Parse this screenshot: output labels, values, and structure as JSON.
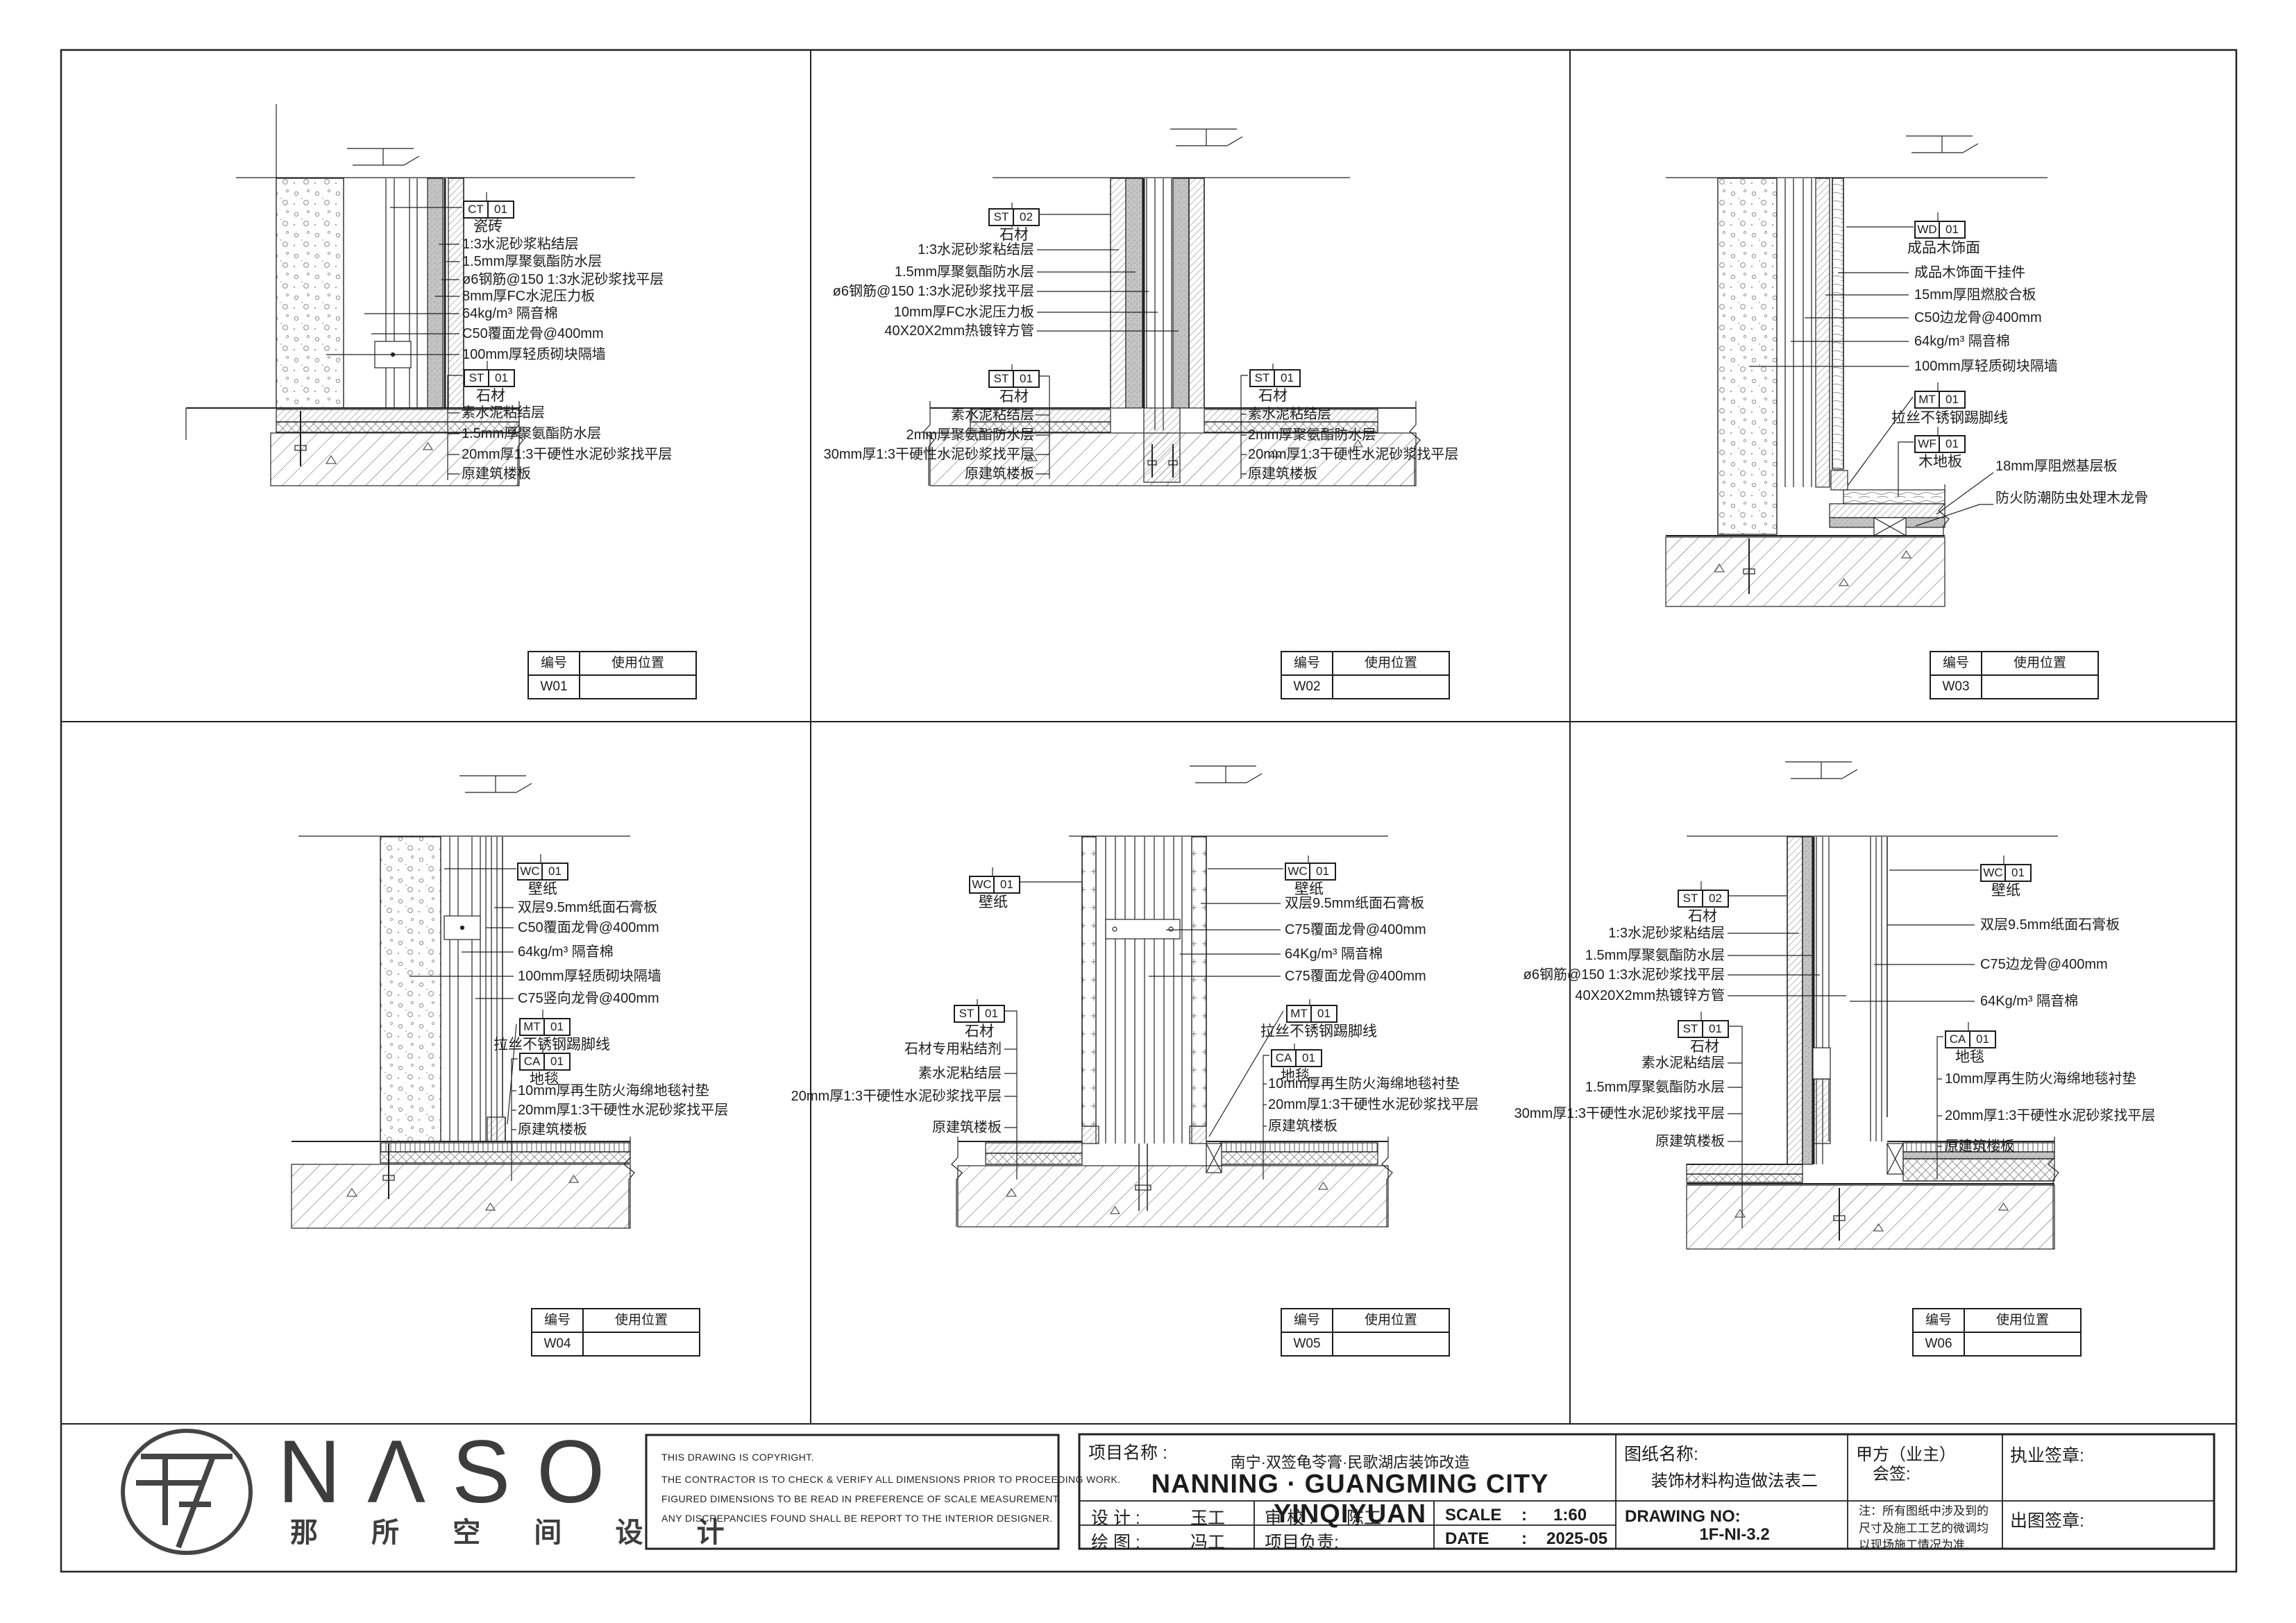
{
  "sheet": {
    "table_headers": {
      "col1": "编号",
      "col2": "使用位置"
    },
    "panels": [
      {
        "id": "W01",
        "tags": [
          {
            "code": "CT",
            "num": "01",
            "name": "瓷砖"
          },
          {
            "code": "ST",
            "num": "01",
            "name": "石材"
          }
        ],
        "g1": [
          "1:3水泥砂浆粘结层",
          "1.5mm厚聚氨酯防水层",
          "ø6钢筋@150 1:3水泥砂浆找平层",
          "8mm厚FC水泥压力板",
          "64kg/m³ 隔音棉",
          "C50覆面龙骨@400mm",
          "100mm厚轻质砌块隔墙"
        ],
        "g2": [
          "素水泥粘结层",
          "1.5mm厚聚氨酯防水层",
          "20mm厚1:3干硬性水泥砂浆找平层",
          "原建筑楼板"
        ]
      },
      {
        "id": "W02",
        "tags": [
          {
            "code": "ST",
            "num": "02",
            "name": "石材"
          },
          {
            "code": "ST",
            "num": "01",
            "name": "石材"
          },
          {
            "code": "ST",
            "num": "01",
            "name": "石材"
          }
        ],
        "g1": [
          "1:3水泥砂浆粘结层",
          "1.5mm厚聚氨酯防水层",
          "ø6钢筋@150 1:3水泥砂浆找平层",
          "10mm厚FC水泥压力板",
          "40X20X2mm热镀锌方管"
        ],
        "g2": [
          "素水泥粘结层",
          "2mm厚聚氨酯防水层",
          "30mm厚1:3干硬性水泥砂浆找平层",
          "原建筑楼板"
        ],
        "g3": [
          "素水泥粘结层",
          "2mm厚聚氨酯防水层",
          "20mm厚1:3干硬性水泥砂浆找平层",
          "原建筑楼板"
        ]
      },
      {
        "id": "W03",
        "tags": [
          {
            "code": "WD",
            "num": "01",
            "name": "成品木饰面"
          },
          {
            "code": "MT",
            "num": "01",
            "name": "拉丝不锈钢踢脚线"
          },
          {
            "code": "WF",
            "num": "01",
            "name": "木地板"
          }
        ],
        "g1": [
          "成品木饰面干挂件",
          "15mm厚阻燃胶合板",
          "C50边龙骨@400mm",
          "64kg/m³ 隔音棉",
          "100mm厚轻质砌块隔墙"
        ],
        "g2": [
          "18mm厚阻燃基层板",
          "防火防潮防虫处理木龙骨"
        ]
      },
      {
        "id": "W04",
        "tags": [
          {
            "code": "WC",
            "num": "01",
            "name": "壁纸"
          },
          {
            "code": "MT",
            "num": "01",
            "name": "拉丝不锈钢踢脚线"
          },
          {
            "code": "CA",
            "num": "01",
            "name": "地毯"
          }
        ],
        "g1": [
          "双层9.5mm纸面石膏板",
          "C50覆面龙骨@400mm",
          "64kg/m³ 隔音棉",
          "100mm厚轻质砌块隔墙",
          "C75竖向龙骨@400mm"
        ],
        "g2": [
          "10mm厚再生防火海绵地毯衬垫",
          "20mm厚1:3干硬性水泥砂浆找平层",
          "原建筑楼板"
        ]
      },
      {
        "id": "W05",
        "tags": [
          {
            "code": "WC",
            "num": "01",
            "name": "壁纸"
          },
          {
            "code": "ST",
            "num": "01",
            "name": "石材"
          },
          {
            "code": "WC",
            "num": "01",
            "name": "壁纸"
          },
          {
            "code": "MT",
            "num": "01",
            "name": "拉丝不锈钢踢脚线"
          },
          {
            "code": "CA",
            "num": "01",
            "name": "地毯"
          }
        ],
        "g1": [
          "石材专用粘结剂",
          "素水泥粘结层",
          "20mm厚1:3干硬性水泥砂浆找平层",
          "原建筑楼板"
        ],
        "g2": [
          "双层9.5mm纸面石膏板",
          "C75覆面龙骨@400mm",
          "64Kg/m³ 隔音棉",
          "C75覆面龙骨@400mm"
        ],
        "g3": [
          "10mm厚再生防火海绵地毯衬垫",
          "20mm厚1:3干硬性水泥砂浆找平层",
          "原建筑楼板"
        ]
      },
      {
        "id": "W06",
        "tags": [
          {
            "code": "ST",
            "num": "02",
            "name": "石材"
          },
          {
            "code": "ST",
            "num": "01",
            "name": "石材"
          },
          {
            "code": "WC",
            "num": "01",
            "name": "壁纸"
          },
          {
            "code": "CA",
            "num": "01",
            "name": "地毯"
          }
        ],
        "g1": [
          "1:3水泥砂浆粘结层",
          "1.5mm厚聚氨酯防水层",
          "ø6钢筋@150 1:3水泥砂浆找平层",
          "40X20X2mm热镀锌方管"
        ],
        "g2": [
          "素水泥粘结层",
          "1.5mm厚聚氨酯防水层",
          "30mm厚1:3干硬性水泥砂浆找平层",
          "原建筑楼板"
        ],
        "g3": [
          "双层9.5mm纸面石膏板",
          "C75边龙骨@400mm",
          "64Kg/m³ 隔音棉"
        ],
        "g4": [
          "10mm厚再生防火海绵地毯衬垫",
          "20mm厚1:3干硬性水泥砂浆找平层",
          "原建筑楼板"
        ]
      }
    ],
    "title_strip": {
      "logo_text": "NΛSO",
      "logo_cn": "那 所 空 间 设 计",
      "copyright_lines": [
        "THIS DRAWING IS COPYRIGHT.",
        "THE CONTRACTOR IS TO CHECK & VERIFY ALL DIMENSIONS PRIOR TO PROCEEDING WORK.",
        "FIGURED DIMENSIONS TO BE READ IN PREFERENCE OF SCALE MEASUREMENT.",
        "ANY DISCREPANCIES FOUND SHALL BE REPORT TO THE INTERIOR DESIGNER."
      ],
      "project_label": "项目名称    :",
      "project_name_cn": "南宁·双签龟苓膏·民歌湖店装饰改造",
      "project_name_en": "NANNING · GUANGMING CITY YINQIYUAN",
      "design_label": "设  计  :",
      "design_value": "玉工",
      "check_label": "审  校  :",
      "check_value": "陈工",
      "scale_label": "SCALE",
      "scale_sep": ":",
      "scale_value": "1:60",
      "draw_label": "绘  图  :",
      "draw_value": "冯工",
      "pm_label": "项目负责:",
      "date_label": "DATE",
      "date_sep": ":",
      "date_value": "2025-05",
      "sheet_name_label": "图纸名称:",
      "sheet_name": "装饰材料构造做法表二",
      "drawing_no_label": "DRAWING NO:",
      "drawing_no": "1F-NI-3.2",
      "client_label": "甲方（业主）",
      "client_sign": "会签:",
      "note": "注：所有图纸中涉及到的尺寸及施工工艺的微调均以现场施工情况为准.",
      "license_label": "执业签章:",
      "issue_label": "出图签章:"
    }
  }
}
